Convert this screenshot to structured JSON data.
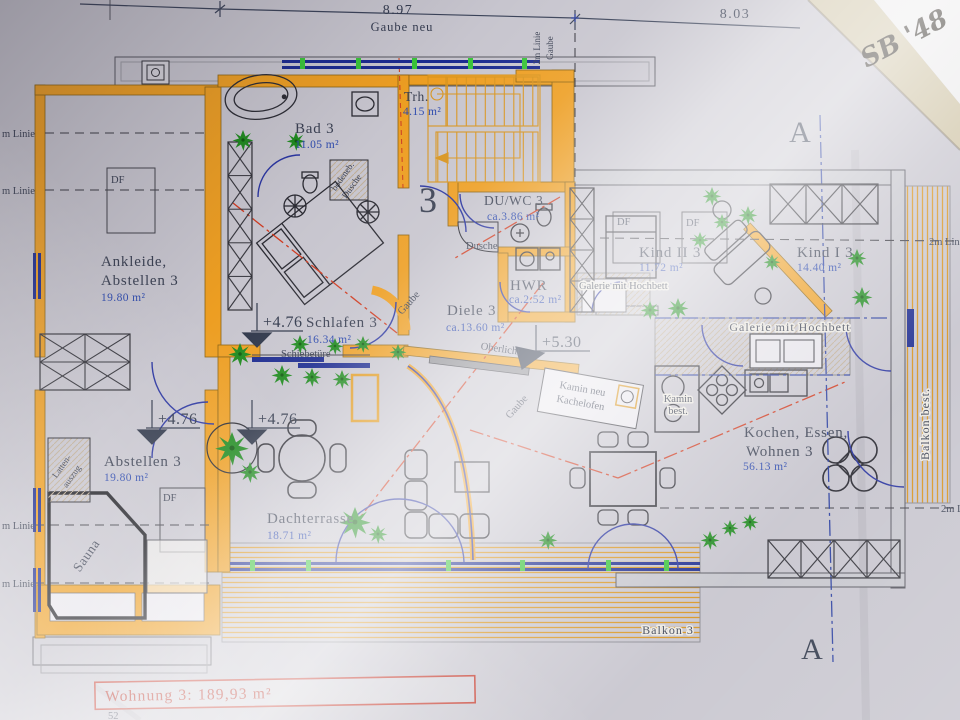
{
  "plan": {
    "apartment_number": "3",
    "dimensions": {
      "width_left": "8.97",
      "width_right": "8.03",
      "gaube_new": "Gaube neu",
      "gaube_line_label_1": "2m Linie",
      "gaube_line_label_2": "Gaube"
    },
    "section_marker": "A",
    "levels": {
      "upper": "+4.76",
      "hall": "+5.30"
    },
    "rooms": {
      "ankleide": {
        "name_line1": "Ankleide,",
        "name_line2": "Abstellen 3",
        "area": "19.80 m²"
      },
      "bad": {
        "name": "Bad 3",
        "area": "11.05 m²"
      },
      "treppenhaus": {
        "name": "Trh.",
        "area": "4.15 m²"
      },
      "du_wc": {
        "name": "DU/WC 3",
        "area": "ca.3.86 m²"
      },
      "hwr": {
        "name": "HWR",
        "area": "ca.2.52 m²"
      },
      "diele": {
        "name": "Diele 3",
        "area": "ca.13.60 m²"
      },
      "schlafen": {
        "name": "Schlafen 3",
        "area": "16.34 m²"
      },
      "kind2": {
        "name": "Kind II 3",
        "area": "11.72 m²"
      },
      "kind1": {
        "name": "Kind I 3",
        "area": "14.40 m²"
      },
      "kochen": {
        "name_line1": "Kochen, Essen,",
        "name_line2": "Wohnen 3",
        "area": "56.13 m²"
      },
      "abstellen": {
        "name": "Abstellen 3",
        "area": "19.80 m²"
      },
      "dachterrasse": {
        "name": "Dachterrasse",
        "area": "18.71 m²"
      },
      "balkon3": {
        "name": "Balkon 3"
      },
      "balkon_best": {
        "name": "Balkon best."
      }
    },
    "annotations": {
      "schiebetuere": "Schiebetüre",
      "oberlicht": "Oberlicht",
      "kamin_neu_line1": "Kamin neu",
      "kamin_neu_line2": "Kachelofen",
      "kamin_best_line1": "Kamin",
      "kamin_best_line2": "best.",
      "galerie": "Galerie mit Hochbett",
      "gaube": "Gaube",
      "dusche": "Dusche",
      "bodeneb_line1": "bodeneb.",
      "bodeneb_line2": "Dusche",
      "sauna": "Sauna",
      "latten_line1": "Latten-",
      "latten_line2": "auszug",
      "dachfenster": "DF",
      "linie_left": "m Linie",
      "linie_2m": "2m Linie"
    },
    "summary": {
      "label": "Wohnung 3: 189,93 m²",
      "partial_number": "52"
    },
    "signature": "SB '48",
    "colors": {
      "wall_orange": "#ED9E22",
      "window_navy": "#1B2A8F",
      "plant_green": "#1E8A1E",
      "roof_line_red": "#CF3A1F",
      "summary_red": "#B5281C",
      "hatch_orange": "#D8941E",
      "ink": "#3A4052",
      "area_blue": "#2C49AD"
    }
  }
}
